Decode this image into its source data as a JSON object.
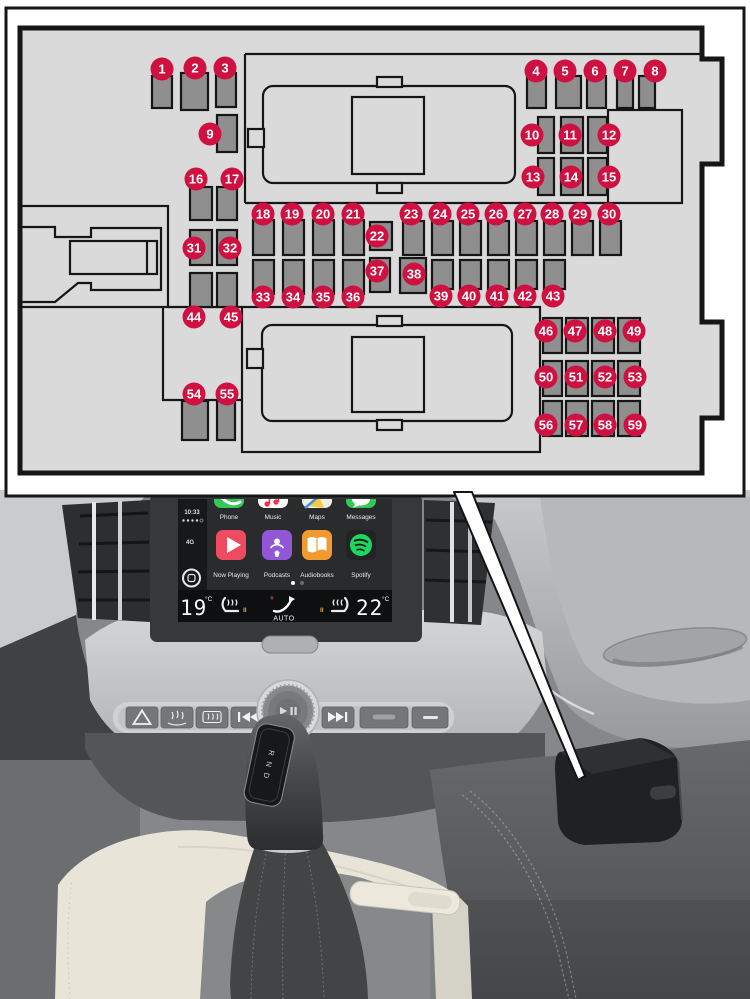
{
  "diagram": {
    "colors": {
      "accent": "#ce1141",
      "panel": "#dadada",
      "slot": "#8f8f8f",
      "line": "#161616"
    },
    "fuses": [
      {
        "n": 1,
        "cx": 162,
        "cy": 69,
        "slot": [
          152,
          76,
          20,
          32
        ]
      },
      {
        "n": 2,
        "cx": 195,
        "cy": 68,
        "slot": [
          181,
          73,
          27,
          37
        ]
      },
      {
        "n": 3,
        "cx": 225,
        "cy": 68,
        "slot": [
          216,
          73,
          20,
          34
        ]
      },
      {
        "n": 4,
        "cx": 536,
        "cy": 71,
        "slot": [
          527,
          76,
          19,
          32
        ]
      },
      {
        "n": 5,
        "cx": 565,
        "cy": 71,
        "slot": [
          556,
          76,
          25,
          32
        ]
      },
      {
        "n": 6,
        "cx": 595,
        "cy": 71,
        "slot": [
          587,
          76,
          19,
          32
        ]
      },
      {
        "n": 7,
        "cx": 625,
        "cy": 71,
        "slot": [
          617,
          76,
          16,
          32
        ]
      },
      {
        "n": 8,
        "cx": 655,
        "cy": 71,
        "slot": [
          639,
          76,
          16,
          32
        ]
      },
      {
        "n": 9,
        "cx": 210,
        "cy": 134,
        "slot": [
          217,
          115,
          20,
          37
        ]
      },
      {
        "n": 10,
        "cx": 532,
        "cy": 135,
        "slot": [
          538,
          117,
          16,
          36
        ]
      },
      {
        "n": 11,
        "cx": 570,
        "cy": 135,
        "slot": [
          561,
          117,
          22,
          36
        ]
      },
      {
        "n": 12,
        "cx": 609,
        "cy": 135,
        "slot": [
          588,
          117,
          19,
          36
        ]
      },
      {
        "n": 13,
        "cx": 533,
        "cy": 177,
        "slot": [
          538,
          158,
          16,
          37
        ]
      },
      {
        "n": 14,
        "cx": 571,
        "cy": 177,
        "slot": [
          561,
          158,
          22,
          37
        ]
      },
      {
        "n": 15,
        "cx": 609,
        "cy": 177,
        "slot": [
          588,
          158,
          19,
          37
        ]
      },
      {
        "n": 16,
        "cx": 196,
        "cy": 179,
        "slot": [
          190,
          187,
          22,
          33
        ]
      },
      {
        "n": 17,
        "cx": 232,
        "cy": 179,
        "slot": [
          217,
          187,
          20,
          33
        ]
      },
      {
        "n": 18,
        "cx": 263,
        "cy": 214,
        "slot": [
          253,
          220,
          21,
          35
        ]
      },
      {
        "n": 19,
        "cx": 292,
        "cy": 214,
        "slot": [
          283,
          220,
          21,
          35
        ]
      },
      {
        "n": 20,
        "cx": 323,
        "cy": 214,
        "slot": [
          313,
          220,
          21,
          35
        ]
      },
      {
        "n": 21,
        "cx": 353,
        "cy": 214,
        "slot": [
          343,
          220,
          21,
          35
        ]
      },
      {
        "n": 22,
        "cx": 377,
        "cy": 236,
        "slot": [
          370,
          222,
          22,
          28
        ]
      },
      {
        "n": 23,
        "cx": 411,
        "cy": 214,
        "slot": [
          403,
          221,
          21,
          34
        ]
      },
      {
        "n": 24,
        "cx": 440,
        "cy": 214,
        "slot": [
          432,
          221,
          21,
          34
        ]
      },
      {
        "n": 25,
        "cx": 468,
        "cy": 214,
        "slot": [
          460,
          221,
          21,
          34
        ]
      },
      {
        "n": 26,
        "cx": 496,
        "cy": 214,
        "slot": [
          488,
          221,
          21,
          34
        ]
      },
      {
        "n": 27,
        "cx": 525,
        "cy": 214,
        "slot": [
          516,
          221,
          21,
          34
        ]
      },
      {
        "n": 28,
        "cx": 552,
        "cy": 214,
        "slot": [
          544,
          221,
          21,
          34
        ]
      },
      {
        "n": 29,
        "cx": 580,
        "cy": 214,
        "slot": [
          572,
          221,
          21,
          34
        ]
      },
      {
        "n": 30,
        "cx": 609,
        "cy": 214,
        "slot": [
          600,
          221,
          21,
          34
        ]
      },
      {
        "n": 31,
        "cx": 194,
        "cy": 248,
        "slot": [
          190,
          230,
          22,
          35
        ]
      },
      {
        "n": 32,
        "cx": 230,
        "cy": 248,
        "slot": [
          217,
          230,
          20,
          35
        ]
      },
      {
        "n": 33,
        "cx": 263,
        "cy": 297,
        "slot": [
          253,
          260,
          21,
          34
        ]
      },
      {
        "n": 34,
        "cx": 293,
        "cy": 297,
        "slot": [
          283,
          260,
          21,
          34
        ]
      },
      {
        "n": 35,
        "cx": 323,
        "cy": 297,
        "slot": [
          313,
          260,
          21,
          34
        ]
      },
      {
        "n": 36,
        "cx": 353,
        "cy": 297,
        "slot": [
          343,
          260,
          21,
          34
        ]
      },
      {
        "n": 37,
        "cx": 377,
        "cy": 271,
        "slot": [
          370,
          258,
          20,
          34
        ]
      },
      {
        "n": 38,
        "cx": 414,
        "cy": 274,
        "slot": [
          400,
          258,
          26,
          35
        ]
      },
      {
        "n": 39,
        "cx": 441,
        "cy": 296,
        "slot": [
          432,
          260,
          21,
          29
        ]
      },
      {
        "n": 40,
        "cx": 469,
        "cy": 296,
        "slot": [
          460,
          260,
          21,
          29
        ]
      },
      {
        "n": 41,
        "cx": 497,
        "cy": 296,
        "slot": [
          488,
          260,
          21,
          29
        ]
      },
      {
        "n": 42,
        "cx": 525,
        "cy": 296,
        "slot": [
          516,
          260,
          21,
          29
        ]
      },
      {
        "n": 43,
        "cx": 553,
        "cy": 296,
        "slot": [
          544,
          260,
          21,
          29
        ]
      },
      {
        "n": 44,
        "cx": 194,
        "cy": 317,
        "slot": [
          190,
          273,
          22,
          34
        ]
      },
      {
        "n": 45,
        "cx": 231,
        "cy": 317,
        "slot": [
          217,
          273,
          20,
          34
        ]
      },
      {
        "n": 46,
        "cx": 546,
        "cy": 331,
        "slot": [
          543,
          318,
          19,
          35
        ]
      },
      {
        "n": 47,
        "cx": 575,
        "cy": 331,
        "slot": [
          566,
          318,
          22,
          35
        ]
      },
      {
        "n": 48,
        "cx": 605,
        "cy": 331,
        "slot": [
          592,
          318,
          22,
          35
        ]
      },
      {
        "n": 49,
        "cx": 634,
        "cy": 331,
        "slot": [
          618,
          318,
          22,
          35
        ]
      },
      {
        "n": 50,
        "cx": 546,
        "cy": 377,
        "slot": [
          543,
          361,
          19,
          35
        ]
      },
      {
        "n": 51,
        "cx": 576,
        "cy": 377,
        "slot": [
          566,
          361,
          22,
          35
        ]
      },
      {
        "n": 52,
        "cx": 605,
        "cy": 377,
        "slot": [
          592,
          361,
          22,
          35
        ]
      },
      {
        "n": 53,
        "cx": 635,
        "cy": 377,
        "slot": [
          618,
          361,
          22,
          35
        ]
      },
      {
        "n": 54,
        "cx": 194,
        "cy": 394,
        "slot": [
          182,
          401,
          26,
          39
        ]
      },
      {
        "n": 55,
        "cx": 227,
        "cy": 394,
        "slot": [
          217,
          401,
          18,
          39
        ]
      },
      {
        "n": 56,
        "cx": 546,
        "cy": 425,
        "slot": [
          543,
          401,
          19,
          35
        ]
      },
      {
        "n": 57,
        "cx": 576,
        "cy": 425,
        "slot": [
          566,
          401,
          22,
          35
        ]
      },
      {
        "n": 58,
        "cx": 605,
        "cy": 425,
        "slot": [
          592,
          401,
          22,
          35
        ]
      },
      {
        "n": 59,
        "cx": 635,
        "cy": 425,
        "slot": [
          618,
          401,
          22,
          35
        ]
      }
    ]
  },
  "screen": {
    "statusbar": {
      "time": "10:33",
      "network": "4G"
    },
    "dock": [
      {
        "name": "phone",
        "label": "Phone",
        "color": "#34c759"
      },
      {
        "name": "music",
        "label": "Music",
        "color": "#ffffff"
      },
      {
        "name": "maps",
        "label": "Maps",
        "color": "#eef0e4"
      },
      {
        "name": "messages",
        "label": "Messages",
        "color": "#34c759"
      }
    ],
    "apps": [
      {
        "name": "now-playing",
        "label": "Now Playing",
        "color": "#ef4b60"
      },
      {
        "name": "podcasts",
        "label": "Podcasts",
        "color": "#9257d6"
      },
      {
        "name": "audiobooks",
        "label": "Audiobooks",
        "color": "#f09a2f"
      },
      {
        "name": "spotify",
        "label": "Spotify",
        "color": "#1ed760"
      }
    ],
    "climate": {
      "left_temp": "19",
      "right_temp": "22",
      "unit": "°C",
      "auto": "AUTO",
      "left_level": "II",
      "right_level": "II"
    }
  },
  "shifter": {
    "gear_indicator": "R N D"
  }
}
